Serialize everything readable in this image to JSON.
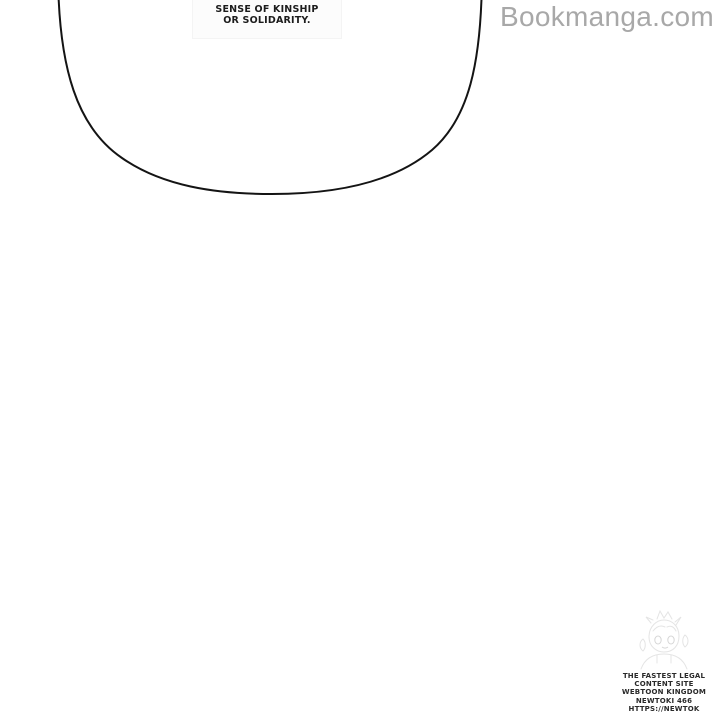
{
  "page": {
    "background": "#ffffff"
  },
  "speech_bubble": {
    "line1": "SENSE OF KINSHIP",
    "line2": "OR SOLIDARITY.",
    "outline_color": "#141414"
  },
  "watermark": {
    "text": "Bookmanga.com",
    "color": "#a8a8a8"
  },
  "footer_stamp": {
    "icon": "newtoki-mascot-sketch",
    "lines": [
      "THE FASTEST LEGAL",
      "CONTENT SITE",
      "WEBTOON KINGDOM",
      "NEWTOKI 466",
      "HTTPS://NEWTOK"
    ],
    "text_color": "#2a2a2a"
  }
}
